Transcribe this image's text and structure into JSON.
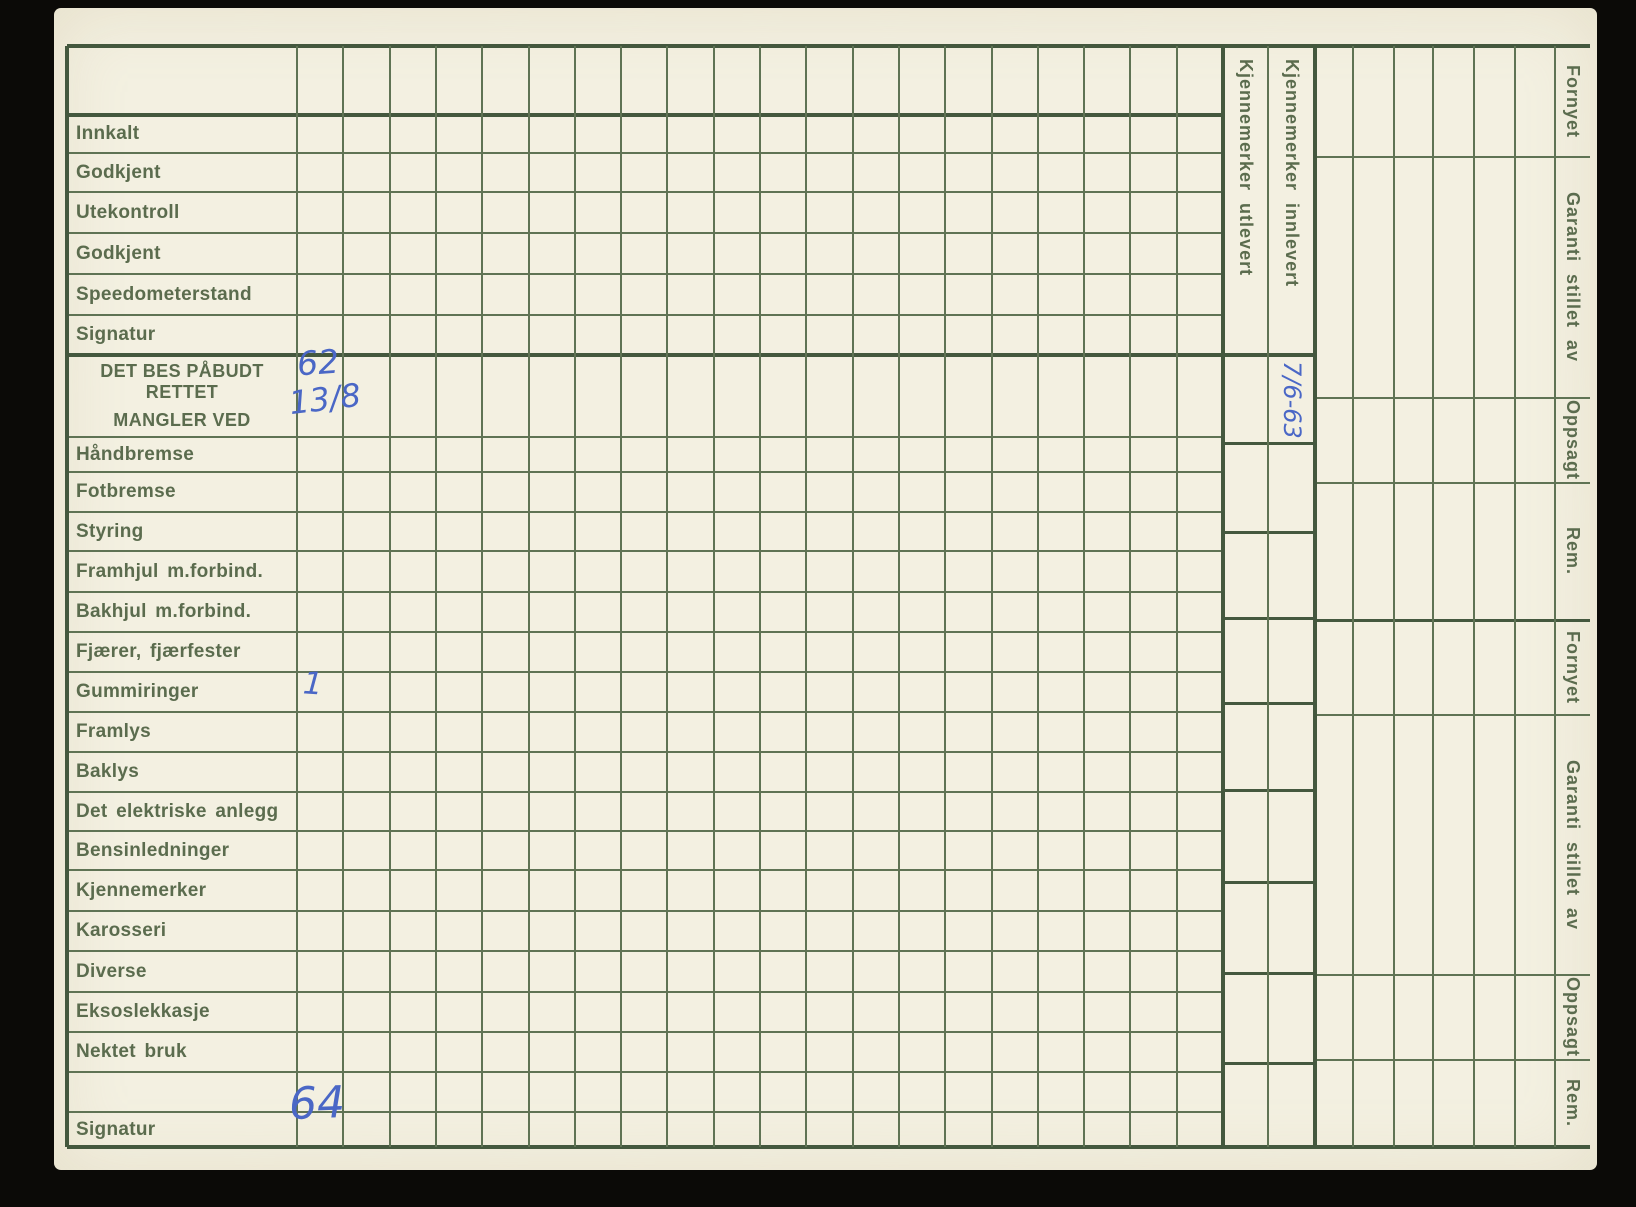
{
  "card": {
    "row_labels": [
      "Innkalt",
      "Godkjent",
      "Utekontroll",
      "Godkjent",
      "Speedometerstand",
      "Signatur"
    ],
    "defect_header": {
      "line1": "DET BES PÅBUDT RETTET",
      "line2": "MANGLER VED"
    },
    "defect_labels": [
      "Håndbremse",
      "Fotbremse",
      "Styring",
      "Framhjul m.forbind.",
      "Bakhjul m.forbind.",
      "Fjærer, fjærfester",
      "Gummiringer",
      "Framlys",
      "Baklys",
      "Det elektriske anlegg",
      "Bensinledninger",
      "Kjennemerker",
      "Karosseri",
      "Diverse",
      "Eksoslekkasje",
      "Nektet bruk"
    ],
    "bottom_label": "Signatur",
    "plate_columns": [
      "Kjennemerker utlevert",
      "Kjennemerker innlevert"
    ],
    "right_edge_labels": [
      "Fornyet",
      "Garanti stillet av",
      "Oppsagt",
      "Rem.",
      "Fornyet",
      "Garanti stillet av",
      "Oppsagt",
      "Rem."
    ],
    "handwriting": {
      "defect_header_cell_top": "62",
      "defect_header_cell_bottom": "13/8",
      "gummiringer_cell": "1",
      "signatur_cell": "64",
      "plate_innlevert_date": "7/6-63"
    },
    "colors": {
      "background": "#0b0a07",
      "paper": "#f3f0e1",
      "grid_line": "#5f7354",
      "grid_line_heavy": "#44583e",
      "print_text": "#5b6c4e",
      "handwriting_ink": "#4a67c6"
    }
  }
}
